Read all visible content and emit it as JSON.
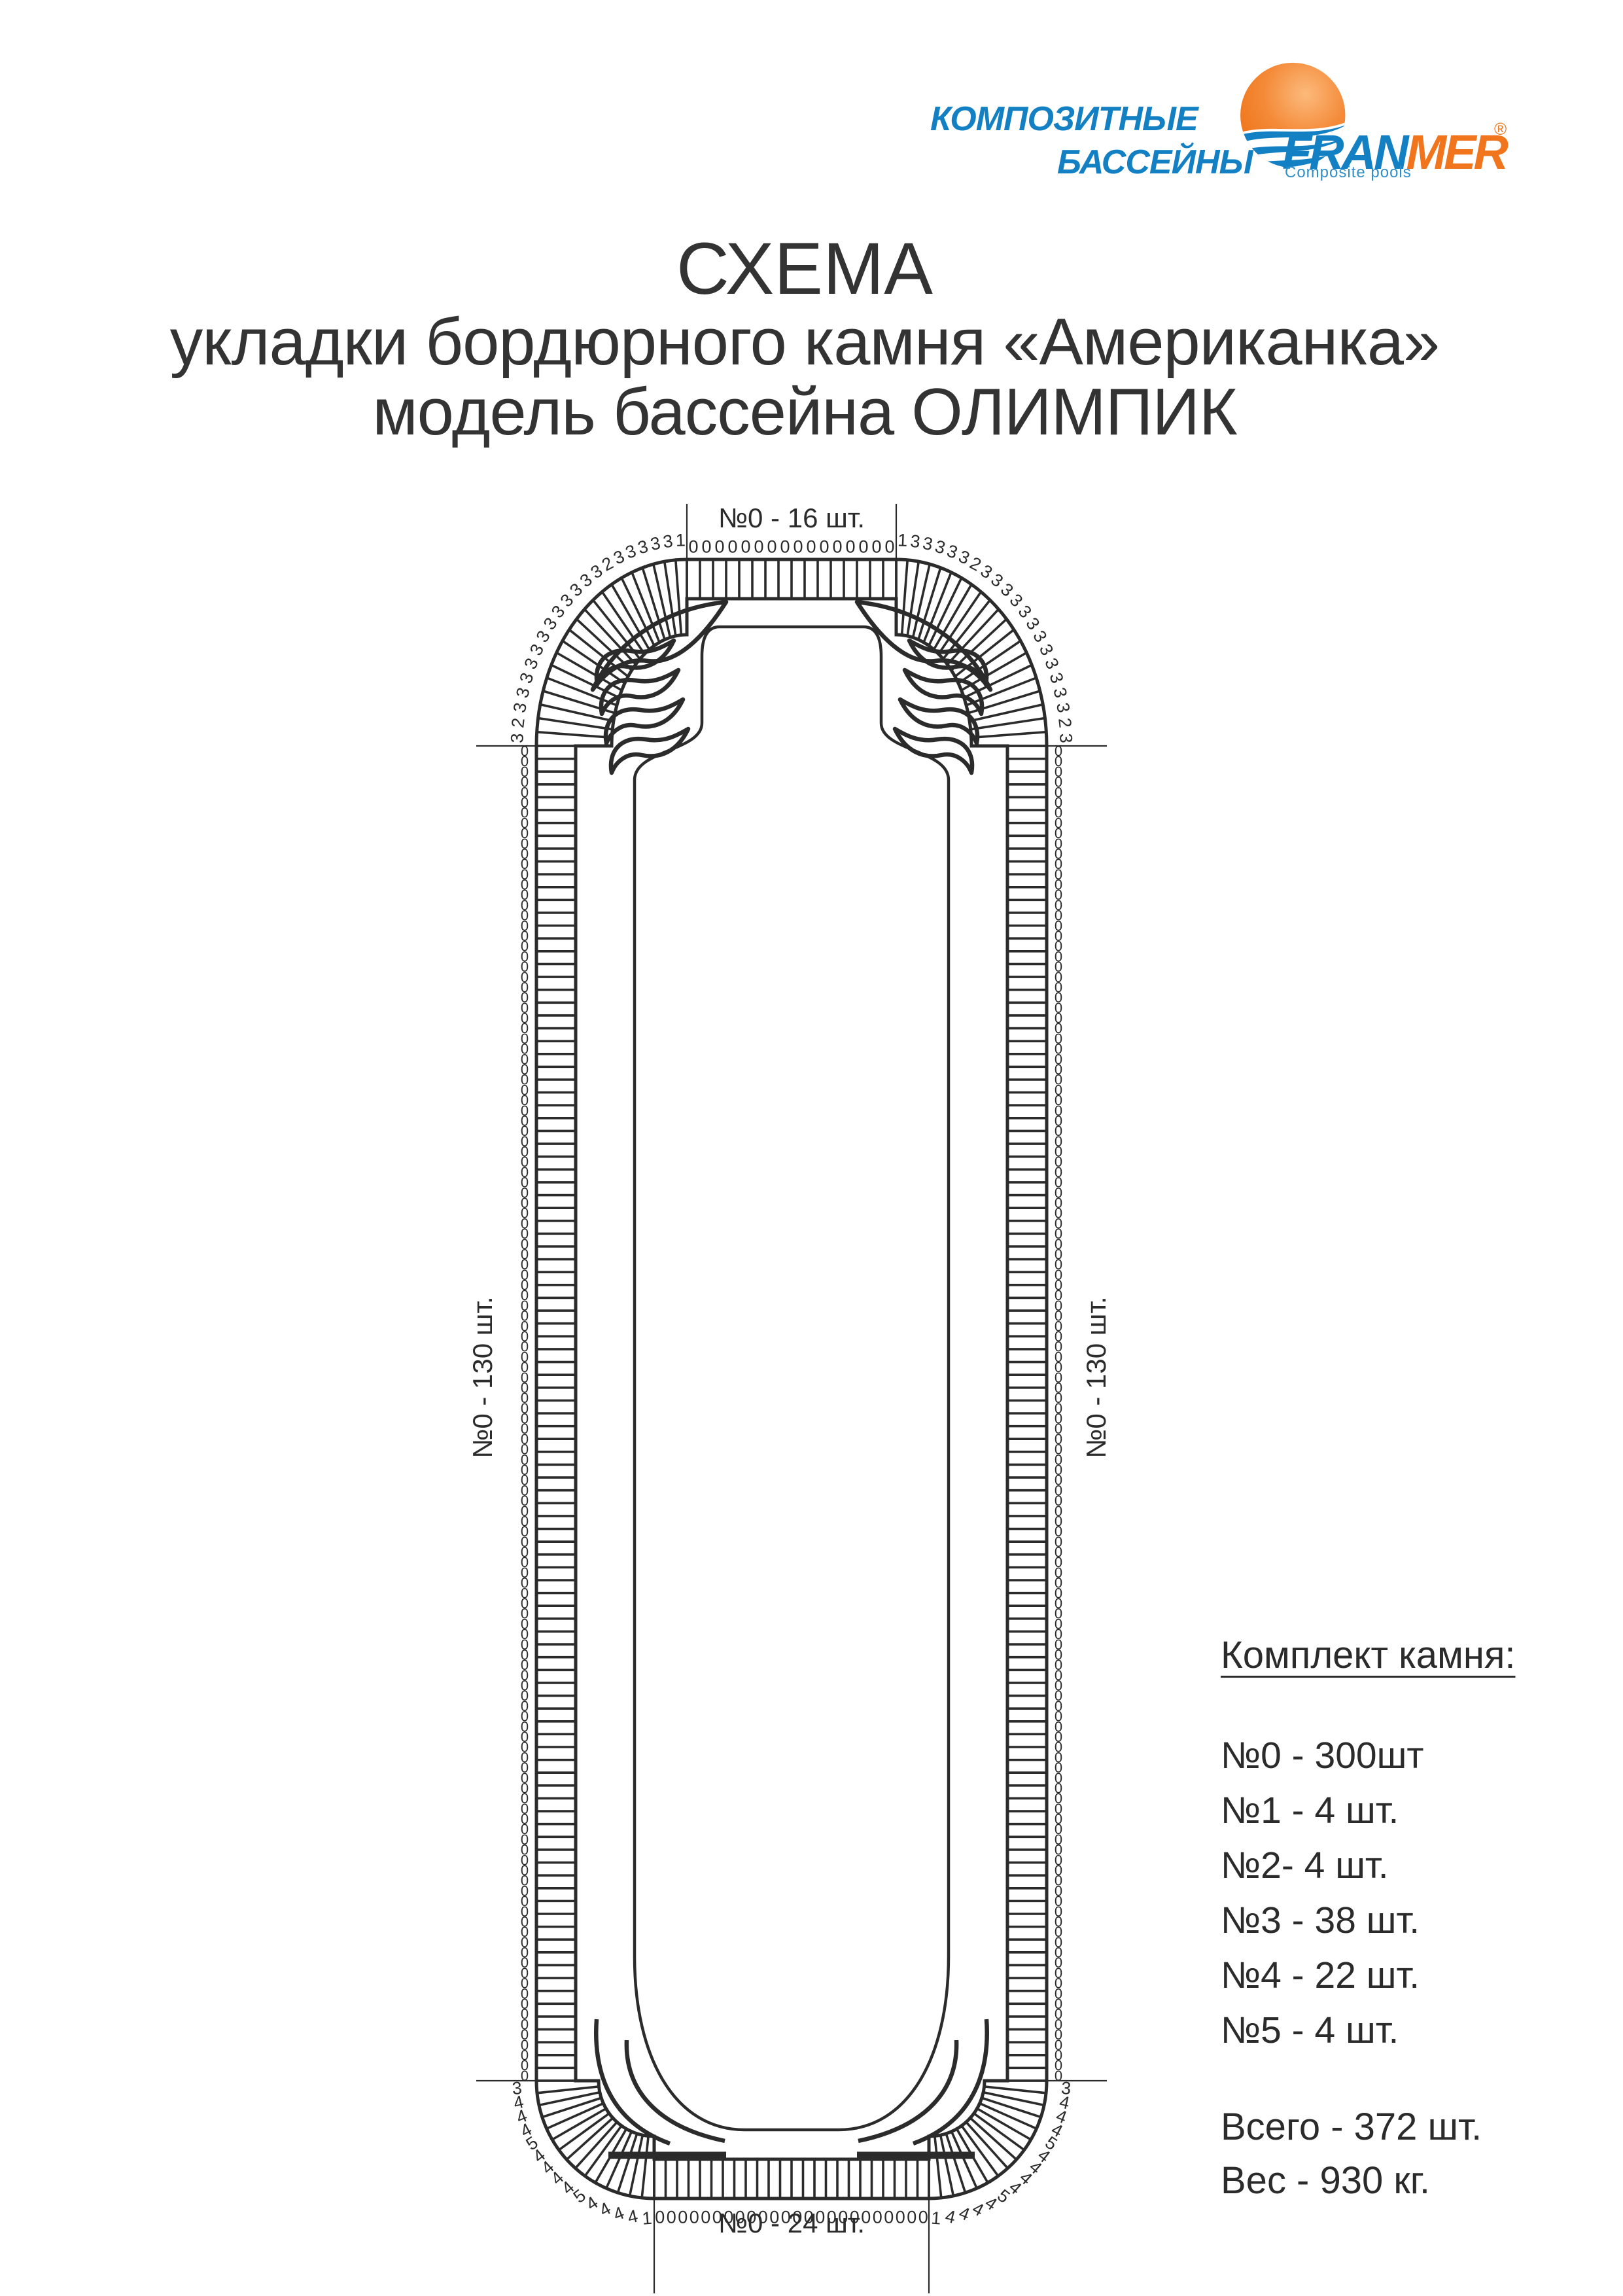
{
  "header": {
    "brand_line1": "КОМПОЗИТНЫЕ",
    "brand_line2": "БАССЕЙНЫ",
    "logo": {
      "fran": "FRAN",
      "mer": "MER",
      "registered": "®",
      "subtitle": "Composite pools"
    }
  },
  "title": {
    "line1": "СХЕМА",
    "line2": "укладки бордюрного камня «Американка»",
    "line3": "модель бассейна ОЛИМПИК"
  },
  "diagram": {
    "labels": {
      "top": "№0 - 16 шт.",
      "bottom": "№0 - 24 шт.",
      "left": "№0 - 130 шт.",
      "right": "№0 - 130 шт."
    },
    "stones": {
      "top_straight": {
        "type": "0",
        "count": 16
      },
      "bottom_straight": {
        "type": "0",
        "count": 24
      },
      "left_side": {
        "type": "0",
        "count": 130
      },
      "right_side": {
        "type": "0",
        "count": 130
      },
      "top_corner_sequence": [
        "1",
        "3",
        "3",
        "3",
        "3",
        "3",
        "2",
        "3",
        "3",
        "3",
        "3",
        "3",
        "3",
        "3",
        "3",
        "3",
        "3",
        "3",
        "3",
        "2",
        "3"
      ],
      "bottom_corner_sequence": [
        "3",
        "4",
        "4",
        "4",
        "5",
        "4",
        "4",
        "4",
        "4",
        "5",
        "4",
        "4",
        "4",
        "4",
        "1"
      ]
    }
  },
  "legend": {
    "title": "Комплект камня:",
    "items": [
      "№0 - 300шт",
      "№1 - 4 шт.",
      "№2- 4 шт.",
      "№3 - 38 шт.",
      "№4 - 22 шт.",
      "№5 - 4 шт."
    ],
    "total": "Всего - 372 шт.",
    "weight": "Вес - 930 кг."
  },
  "colors": {
    "brand_blue": "#1480c4",
    "brand_orange": "#f0751c",
    "ink": "#2b2b2b"
  }
}
